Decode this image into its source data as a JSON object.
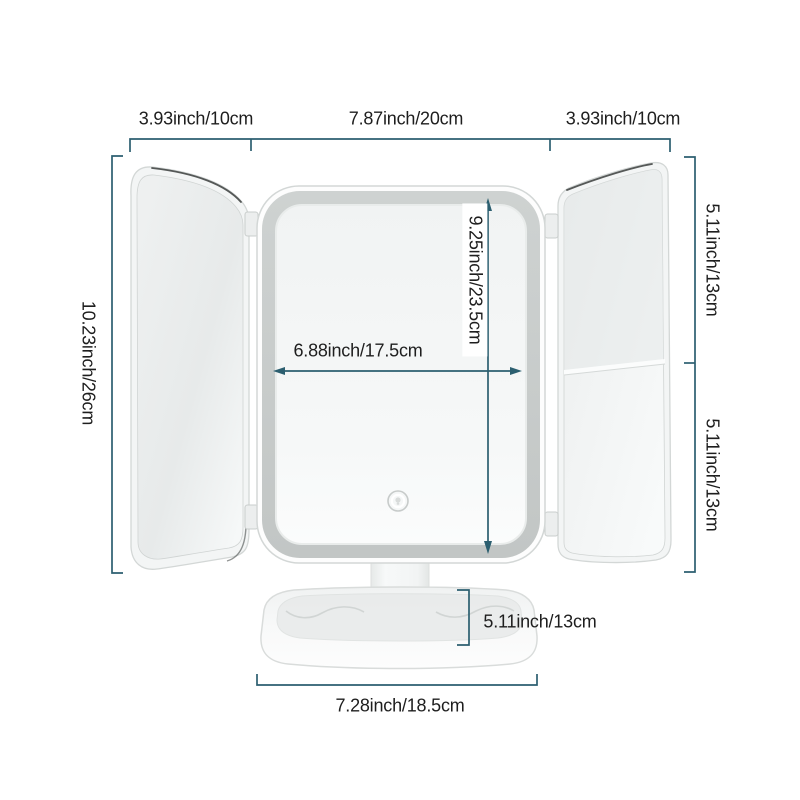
{
  "accent_color": "#2c5f70",
  "text_color": "#1e1e1e",
  "product": {
    "name": "trifold lighted vanity mirror with storage base",
    "touch_icon": "power-touch-icon"
  },
  "dimensions": {
    "left_panel_width": "3.93inch/10cm",
    "center_panel_width": "7.87inch/20cm",
    "right_panel_width": "3.93inch/10cm",
    "overall_height": "10.23inch/26cm",
    "right_upper_section_height": "5.11inch/13cm",
    "right_lower_section_height": "5.11inch/13cm",
    "mirror_surface_height": "9.25inch/23.5cm",
    "mirror_surface_width": "6.88inch/17.5cm",
    "base_section_height": "5.11inch/13cm",
    "base_width": "7.28inch/18.5cm"
  }
}
